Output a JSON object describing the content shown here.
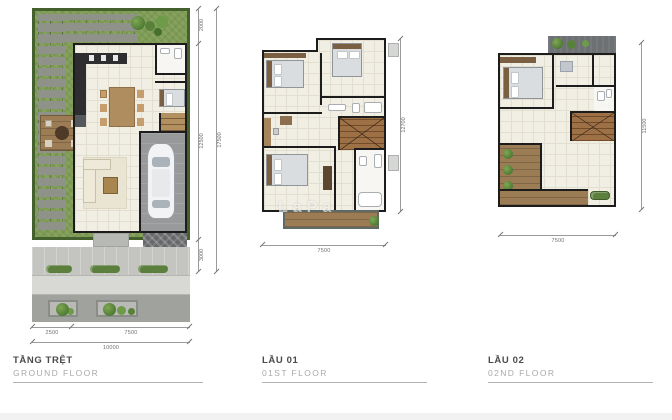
{
  "plans": [
    {
      "title": "TẦNG TRỆT",
      "subtitle": "GROUND FLOOR",
      "dims": {
        "right_top": "2000",
        "right_mid": "12500",
        "right_bottom": "3000",
        "right_total": "17500",
        "bottom_left": "2500",
        "bottom_right": "7500",
        "bottom_total": "10000"
      }
    },
    {
      "title": "LẦU 01",
      "subtitle": "01ST FLOOR",
      "dims": {
        "bottom": "7500",
        "right": "12700"
      }
    },
    {
      "title": "LẦU 02",
      "subtitle": "02ND FLOOR",
      "dims": {
        "bottom": "7500",
        "right": "11500"
      }
    }
  ],
  "watermark": "LaPa",
  "colors": {
    "grass": "#7f9c55",
    "hedge": "#44602c",
    "wall": "#1c1c1c",
    "floor": "#f1eee3",
    "wood": "#a6855c",
    "roof": "#6d7173",
    "pavement": "#c4c5c1",
    "plant_green": "#4e7a33"
  }
}
